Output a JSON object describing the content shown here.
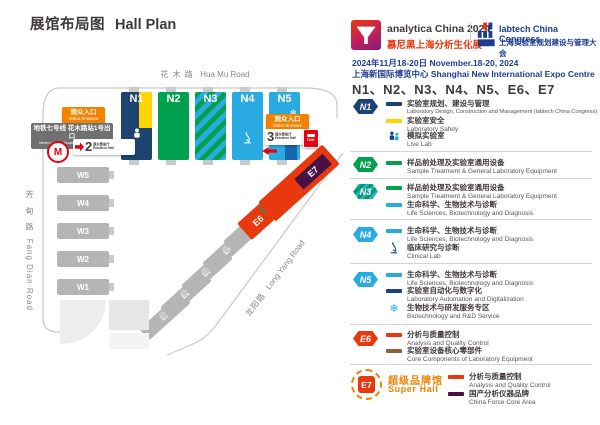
{
  "page": {
    "title_zh": "展馆布局图",
    "title_en": "Hall Plan"
  },
  "header": {
    "analytica": {
      "name": "analytica China 2024",
      "subtitle": "慕尼黑上海分析生化展"
    },
    "labtech": {
      "name": "labtech China Congress",
      "subtitle": "上海实验室规划建设与管理大会"
    },
    "date": "2024年11月18-20日 November.18-20, 2024",
    "venue": "上海新国际博览中心 Shanghai New International Expo Centre",
    "halls": "N1、N2、N3、N4、N5、E6、E7"
  },
  "map": {
    "roads": {
      "top_zh": "花 木 路",
      "top_en": "Hua Mu Road",
      "left_zh": "芳 甸 路",
      "left_en": "Fang Dian Road",
      "right_zh": "龙阳路",
      "right_en": "Long Yang Road"
    },
    "halls_n": [
      "N1",
      "N2",
      "N3",
      "N4",
      "N5"
    ],
    "halls_w": [
      "W5",
      "W4",
      "W3",
      "W2",
      "W1"
    ],
    "halls_e": [
      "E1",
      "E2",
      "E3",
      "E4",
      "E5"
    ],
    "e6_label": "E6",
    "e7_label": "E7",
    "entrance_left": {
      "zh": "观众入口",
      "en": "Visitor Entrance"
    },
    "entrance_right": {
      "zh": "观众入口",
      "en": "Visitor Entrance"
    },
    "metro": {
      "line1": "地铁七号线 花木路站1号出口",
      "line2": "Metro Line 7, Huamu Rd. Station Exit 1"
    },
    "gate2": {
      "num": "2",
      "zh": "观众登录厅",
      "en": "Entrance Hall"
    },
    "gate3": {
      "num": "3",
      "zh": "观众登录厅",
      "en": "Entrance Hall"
    },
    "taxi": "TAXI"
  },
  "legend": {
    "sections": [
      {
        "badge": "N1",
        "rows": [
          {
            "zh": "实验室规划、建设与管理",
            "en": "Laboratory Design, Construction and Management (labtech China Congress)"
          },
          {
            "zh": "实验室安全",
            "en": "Laboratory Safety"
          },
          {
            "zh": "模拟实验室",
            "en": "Live Lab"
          }
        ]
      },
      {
        "badge": "N2",
        "rows": [
          {
            "zh": "样品前处理及实验室通用设备",
            "en": "Sample Treatment & General Laboratory Equipment"
          }
        ]
      },
      {
        "badge": "N3",
        "rows": [
          {
            "zh": "样品前处理及实验室通用设备",
            "en": "Sample Treatment & General Laboratory Equipment"
          },
          {
            "zh": "生命科学、生物技术与诊断",
            "en": "Life Sciences, Biotechnology and Diagnosis"
          }
        ]
      },
      {
        "badge": "N4",
        "rows": [
          {
            "zh": "生命科学、生物技术与诊断",
            "en": "Life Sciences, Biotechnology and Diagnosis"
          },
          {
            "zh": "临床研究与诊断",
            "en": "Clinical Lab"
          }
        ]
      },
      {
        "badge": "N5",
        "rows": [
          {
            "zh": "生命科学、生物技术与诊断",
            "en": "Life Sciences, Biotechnology and Diagnosis"
          },
          {
            "zh": "实验室自动化与数字化",
            "en": "Laboratory Automation and Digitalization"
          },
          {
            "zh": "生物技术与研发服务专区",
            "en": "Biotechnology and R&D Service"
          }
        ]
      },
      {
        "badge": "E6",
        "rows": [
          {
            "zh": "分析与质量控制",
            "en": "Analysis and Quality Control"
          },
          {
            "zh": "实验室设备核心零部件",
            "en": "Core Components of Laboratory Equipment"
          }
        ]
      }
    ],
    "e7": {
      "badge": "E7",
      "super_zh": "超级品牌馆",
      "super_en": "Super Hall",
      "rows": [
        {
          "zh": "分析与质量控制",
          "en": "Analysis and Quality Control"
        },
        {
          "zh": "国产分析仪器品牌",
          "en": "China Force Core Area"
        }
      ]
    }
  },
  "icons": {
    "snowflake": "❄",
    "metro": "M"
  },
  "colors": {
    "navy": "#1d4373",
    "green": "#00a04e",
    "light_blue": "#29abe2",
    "mid_blue": "#1666ad",
    "yellow": "#ffd400",
    "red": "#e8380d",
    "orange": "#f08300",
    "brown": "#8c6239",
    "purple": "#471144",
    "gray_hall": "#b5b5b6",
    "metro_red": "#e60012",
    "header_blue": "#1c3d8f"
  }
}
